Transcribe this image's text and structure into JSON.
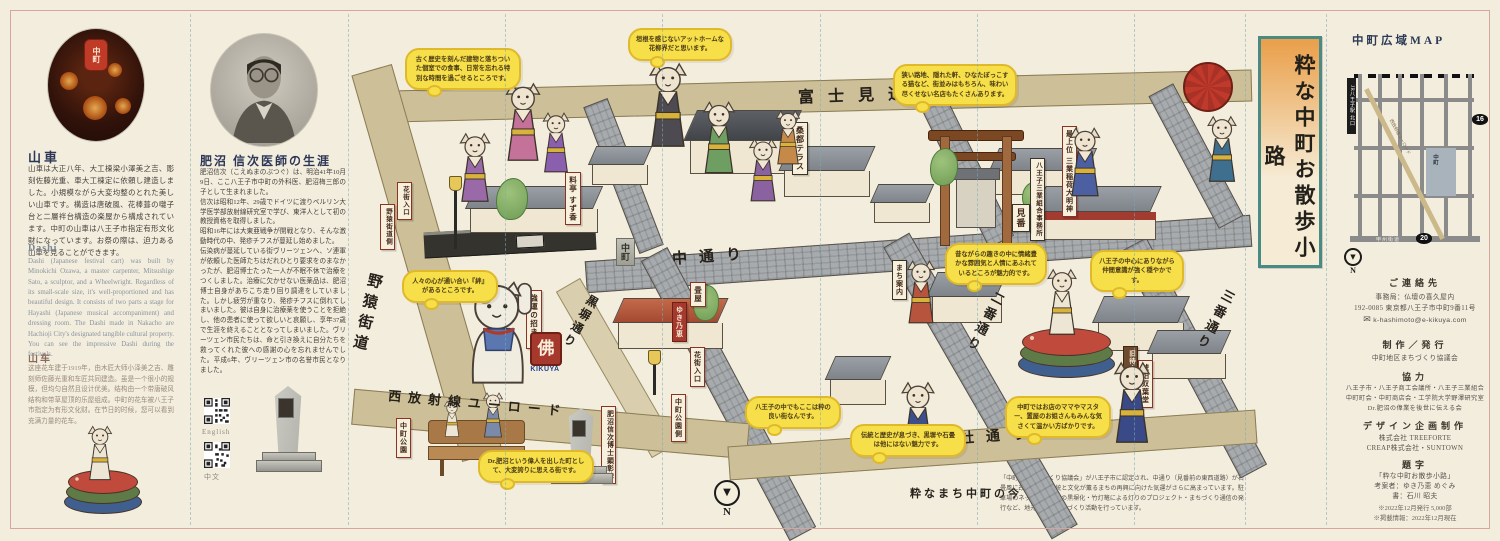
{
  "left_panel": {
    "jp": {
      "heading": "山車",
      "body": "山車は大正八年、大工棟梁小澤美之吉、彫刻佐藤光重、車大工棟定に依頼し建造しました。小規模ながら大変均整のとれた美しい山車です。構造は唐破風、花棒葺の囃子台と二層袢台構造の楽屋から構成されています。中町の山車は八王子市指定有形文化財になっています。お祭の際は、迫力ある山車を見ることができます。"
    },
    "en": {
      "heading": "Dashi",
      "body": "Dashi (Japanese festival cart) was built by Minokichi Ozawa, a master carpenter, Mitsushige Sato, a sculptor, and a Wheelwright. Regardless of its small-scale size, it's well-proportioned and has beautiful design. It consists of two parts a stage for Hayashi (Japanese musical accompaniment) and dressing room. The Dashi made in Nakacho are Hachioji City's designated tangible cultural property. You can see the impressive Dashi during the festivals."
    },
    "zh": {
      "heading": "山车",
      "body": "这座花车建于1919年，由木匠大师小泽美之吉、雕刻师佐藤光重和车匠共同建造。虽是一个很小的规模，但均匀自然且设计优美。结构由一个带唐破风结构和带草屋顶的乐屋组成。中町的花车被八王子市指定为有形文化财。在节日的时候，您可以看到充满力量的花车。"
    }
  },
  "doctor_panel": {
    "heading": "肥沼 信次医師の生涯",
    "body": "肥沼信次（こえぬまのぶつぐ）は、明治41年10月9日、ここ八王子市中町の外科医、肥沼梅三郎の子として生まれました。\n信次は昭和12年、29歳でドイツに渡りベルリン大学医学部放射線研究室で学び、東洋人として初の教授資格を取得しました。\n昭和16年には大東亜戦争が開戦となり、そんな激動時代の中、発疹チフスが蔓延し始めました。\n伝染病が蔓延している街ヴリーツェンへ、ソ連軍が依頼した医師たちはだれひとり要求をのまなかったが、肥沼博士たった一人が不眠不休で治療をつくしました。治療に欠かせない医薬品は、肥沼博士自身があちこち走り回り調達をしていました。しかし疲労が重なり、発疹チフスに倒れてしまいました。彼は自身に治療薬を使うことを拒絶し、他の患者に使って欲しいと哀願し、享年37歳で生涯を終えることとなってしまいました。ヴリーツェン市民たちは、命と引き換えに自分たちを救ってくれた彼への感謝の心を忘れませんでした。平成6年、ヴリーツェン市の名誉市民となりました。",
    "qr": [
      {
        "label": "English"
      },
      {
        "label": "中文"
      }
    ]
  },
  "map": {
    "streets": [
      {
        "label": "富士見通り"
      },
      {
        "label": "中通り"
      },
      {
        "label": "黒塀通り"
      },
      {
        "label": "二番通り"
      },
      {
        "label": "三番通り"
      },
      {
        "label": "野猿街道"
      },
      {
        "label": "西放射線ユーロード"
      },
      {
        "label": "子安神社通り"
      }
    ],
    "signs": [
      {
        "text": "桑都テラス"
      },
      {
        "text": "料亭 すず香"
      },
      {
        "text": "最上位 三業稲荷大明神"
      },
      {
        "text": "八王子三業組合事務所"
      },
      {
        "text": "見番"
      },
      {
        "text": "まち案内"
      },
      {
        "text": "畳屋"
      },
      {
        "text": "ゆき乃恵"
      },
      {
        "text": "花街入口"
      },
      {
        "text": "中町公園側"
      },
      {
        "text": "花街入口"
      },
      {
        "text": "野猿街道側"
      },
      {
        "text": "中町公園"
      },
      {
        "text": "肥沼信次博士顕彰碑"
      },
      {
        "text": "強運の招き猫"
      },
      {
        "text": "旧待合"
      },
      {
        "text": "琥珀双葉堂"
      }
    ],
    "bubbles": [
      {
        "text": "古く歴史を刻んだ建物と落ちついた個室での食事、日常を忘れる特別な時間を過ごせるところです。"
      },
      {
        "text": "垣根を感じないアットホームな花柳界だと思います。"
      },
      {
        "text": "狭い路地、隠れた軒、ひなたぼっこする猫など、街並みはもちろん、味わい尽くせない名店もたくさんあります。"
      },
      {
        "text": "昔ながらの趣きの中に情緒豊かな雰囲気と人情にあふれているところが魅力的です。"
      },
      {
        "text": "八王子の中心にありながら仲間意識が強く穏やかです。"
      },
      {
        "text": "人々の心が通い合い『絆』があるところです。"
      },
      {
        "text": "八王子の中でもここは粋の良い街なんです。"
      },
      {
        "text": "伝統と歴史が息づき、黒塀や石畳は他にはない魅力です。"
      },
      {
        "text": "中町ではお店のママやマスター、置屋のお姐さんもみんな気さくて温かい方ばかりです。"
      },
      {
        "text": "Dr.肥沼という偉人を出した町として、大変誇りに思える街です。"
      }
    ],
    "pillar_label": "中町",
    "kikuya": {
      "kanji": "佛",
      "romaji": "KIKUYA"
    },
    "north_label": "N",
    "now": {
      "heading": "粋なまち中町の今",
      "body": "「中町地区まちづくり協議会」が八王子市に認定され、中通り（見番前の東西道路）が石畳風に改修され、伝統と文化が薫るまちの再興に向けた気運がさらに高まっています。駐車場のネットフェンスの黒塀化・竹灯篭による灯りのプロジェクト・まちづくり通信の発行など、地元主体のまちづくり活動を行っています。"
    }
  },
  "right_panel": {
    "banner_title": "粋な中町お散歩小路",
    "wide_map": {
      "title": "中町広域MAP",
      "station": "JR八王子駅 北口",
      "route16": "16",
      "route20": "20",
      "euro_road": "西放射線ユーロード",
      "koshu": "甲州街道",
      "block": "中町",
      "north": "N"
    },
    "contact": {
      "heading": "ご連絡先",
      "line1": "事務局：仏壇の喜久屋内",
      "line2": "192-0085 東京都八王子市中町9番11号",
      "email_icon": "✉",
      "email": "k-hashimoto@e-kikuya.com"
    },
    "publish": {
      "heading": "制作／発行",
      "body": "中町地区まちづくり協議会"
    },
    "coop": {
      "heading": "協力",
      "line1": "八王子市・八王子商工会議所・八王子三業組合",
      "line2": "中町町会・中町商店会・工学院大学野澤研究室",
      "line3": "Dr.肥沼の偉業を後世に伝える会"
    },
    "design": {
      "heading": "デザイン企画制作",
      "line1": "株式会社 TREEFORTE",
      "line2": "CREAP株式会社・SUNTOWN"
    },
    "daiji": {
      "heading": "題字",
      "line1": "「粋な中町お散歩小路」",
      "line2": "考案者：ゆき乃恵 めぐみ",
      "line3": "書：石川 昭夫"
    },
    "footer": {
      "line1": "※2022年12月発行 5,000部",
      "line2": "※掲載情報：2022年12月現在"
    }
  }
}
